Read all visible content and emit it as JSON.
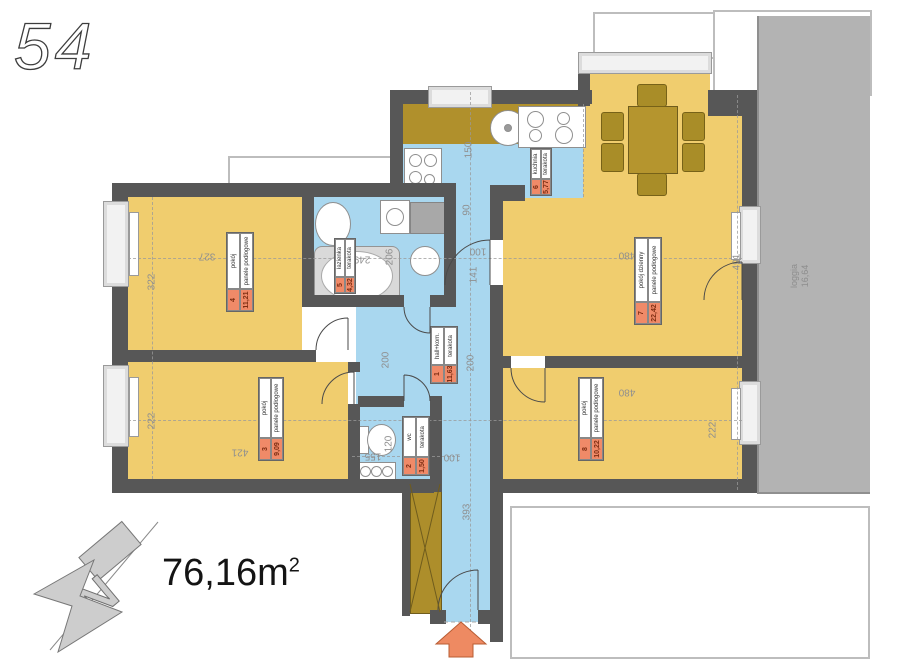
{
  "plan": {
    "number": "54"
  },
  "total_area": {
    "value": "76,16m",
    "sup": "2"
  },
  "north": {
    "letter": "N"
  },
  "loggia": {
    "name": "loggia",
    "area": "16,64"
  },
  "rooms": {
    "r1": {
      "number": "1",
      "name": "hall+kom.",
      "floor": "terakota",
      "area": "11,63"
    },
    "r2": {
      "number": "2",
      "name": "wc",
      "floor": "terakota",
      "area": "1,50"
    },
    "r3": {
      "number": "3",
      "name": "pokój",
      "floor": "panele podłogowe",
      "area": "9,09"
    },
    "r4": {
      "number": "4",
      "name": "pokój",
      "floor": "panele podłogowe",
      "area": "11,21"
    },
    "r5": {
      "number": "5",
      "name": "łazienka",
      "floor": "terakota",
      "area": "4,32"
    },
    "r6": {
      "number": "6",
      "name": "kuchnia",
      "floor": "terakota",
      "area": "5,77"
    },
    "r7": {
      "number": "7",
      "name": "pokój dzienny",
      "floor": "panele podłogowe",
      "area": "22,42"
    },
    "r8": {
      "number": "8",
      "name": "pokój",
      "floor": "panele podłogowe",
      "area": "10,22"
    }
  },
  "dims": {
    "k322": "322",
    "k327": "327",
    "k222l": "222",
    "k421": "421",
    "k249": "249",
    "k206": "206",
    "k200a": "200",
    "k200b": "200",
    "k150": "150",
    "k90": "90",
    "k100a": "100",
    "k141": "141",
    "k480a": "480",
    "k491": "491",
    "k480b": "480",
    "k222r": "222",
    "k155": "155",
    "k120": "120",
    "k100b": "100",
    "k393": "393"
  },
  "colors": {
    "room_yellow": "#f0cd6e",
    "floor_blue": "#a9d7ef",
    "wall_gray": "#575757",
    "counter_olive": "#b0902c",
    "label_orange": "#f08a68",
    "entry_arrow": "#ee8a62",
    "loggia_gray": "#b3b3b3"
  }
}
